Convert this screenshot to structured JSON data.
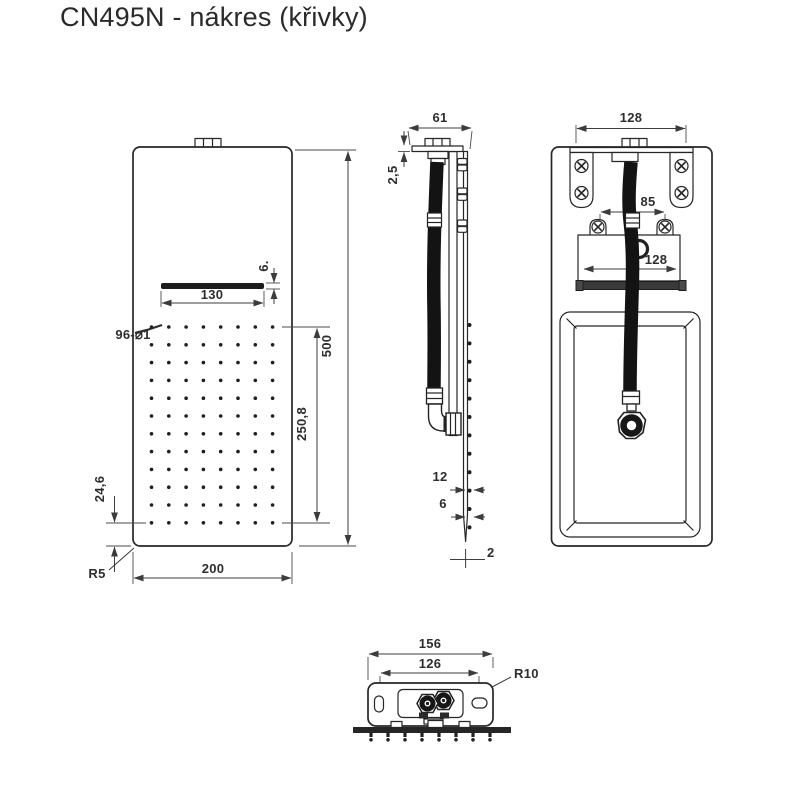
{
  "title": "CN495N - nákres (křivky)",
  "front_view": {
    "dims": {
      "slot_height": "6.",
      "slot_width": "130",
      "holes_label": "96-⌀1",
      "height": "500",
      "dots_span": "250,8",
      "bottom_offset": "24,6",
      "corner_radius": "R5",
      "width": "200"
    },
    "grid": {
      "cols": 8,
      "rows": 12,
      "x0": 151.5,
      "y0": 327,
      "dx": 17.3,
      "dy": 17.8,
      "r": 1.8
    }
  },
  "side_view": {
    "dims": {
      "width": "61",
      "plate_thickness": "2,5",
      "nozzle_pitch": "12",
      "nozzle_inset": "6",
      "panel_thickness": "2"
    },
    "nozzles": {
      "count": 12,
      "x": 469.5,
      "y0": 325,
      "dy": 18.4,
      "r": 2
    }
  },
  "back_view": {
    "dims": {
      "top_span": "128",
      "tab_span": "85",
      "box_width": "128"
    }
  },
  "bottom_view": {
    "dims": {
      "width": "156",
      "slot_span": "126",
      "corner_radius": "R10"
    },
    "teeth": {
      "count": 8,
      "x0": 371,
      "dx": 17,
      "y": 732.5
    }
  },
  "colors": {
    "line": "#262626",
    "dim": "#3c3c3c",
    "fill_dark": "#1d1d1d",
    "background": "#ffffff"
  }
}
